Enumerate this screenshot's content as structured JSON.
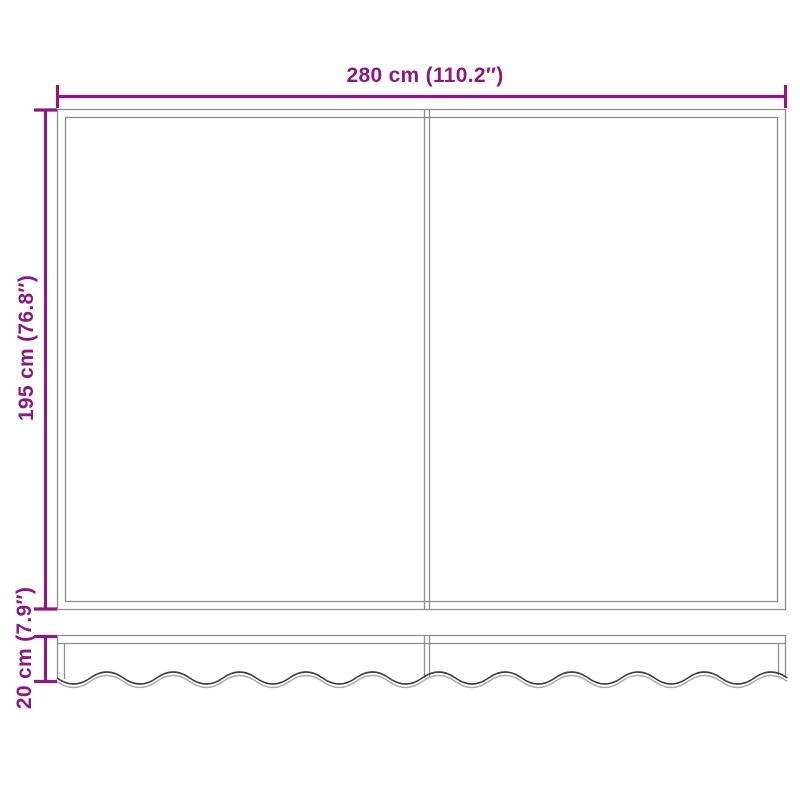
{
  "diagram": {
    "type": "product-dimension-diagram",
    "subject": "awning fabric with scalloped valance",
    "labels": {
      "width": "280 cm (110.2″)",
      "height": "195 cm (76.8″)",
      "valance_height": "20 cm (7.9″)"
    },
    "colors": {
      "accent": "#8a1a7c",
      "outline": "#8f8f8f",
      "wave_dark": "#3f3f3f",
      "wave_light": "#ababab",
      "background": "#ffffff"
    }
  }
}
